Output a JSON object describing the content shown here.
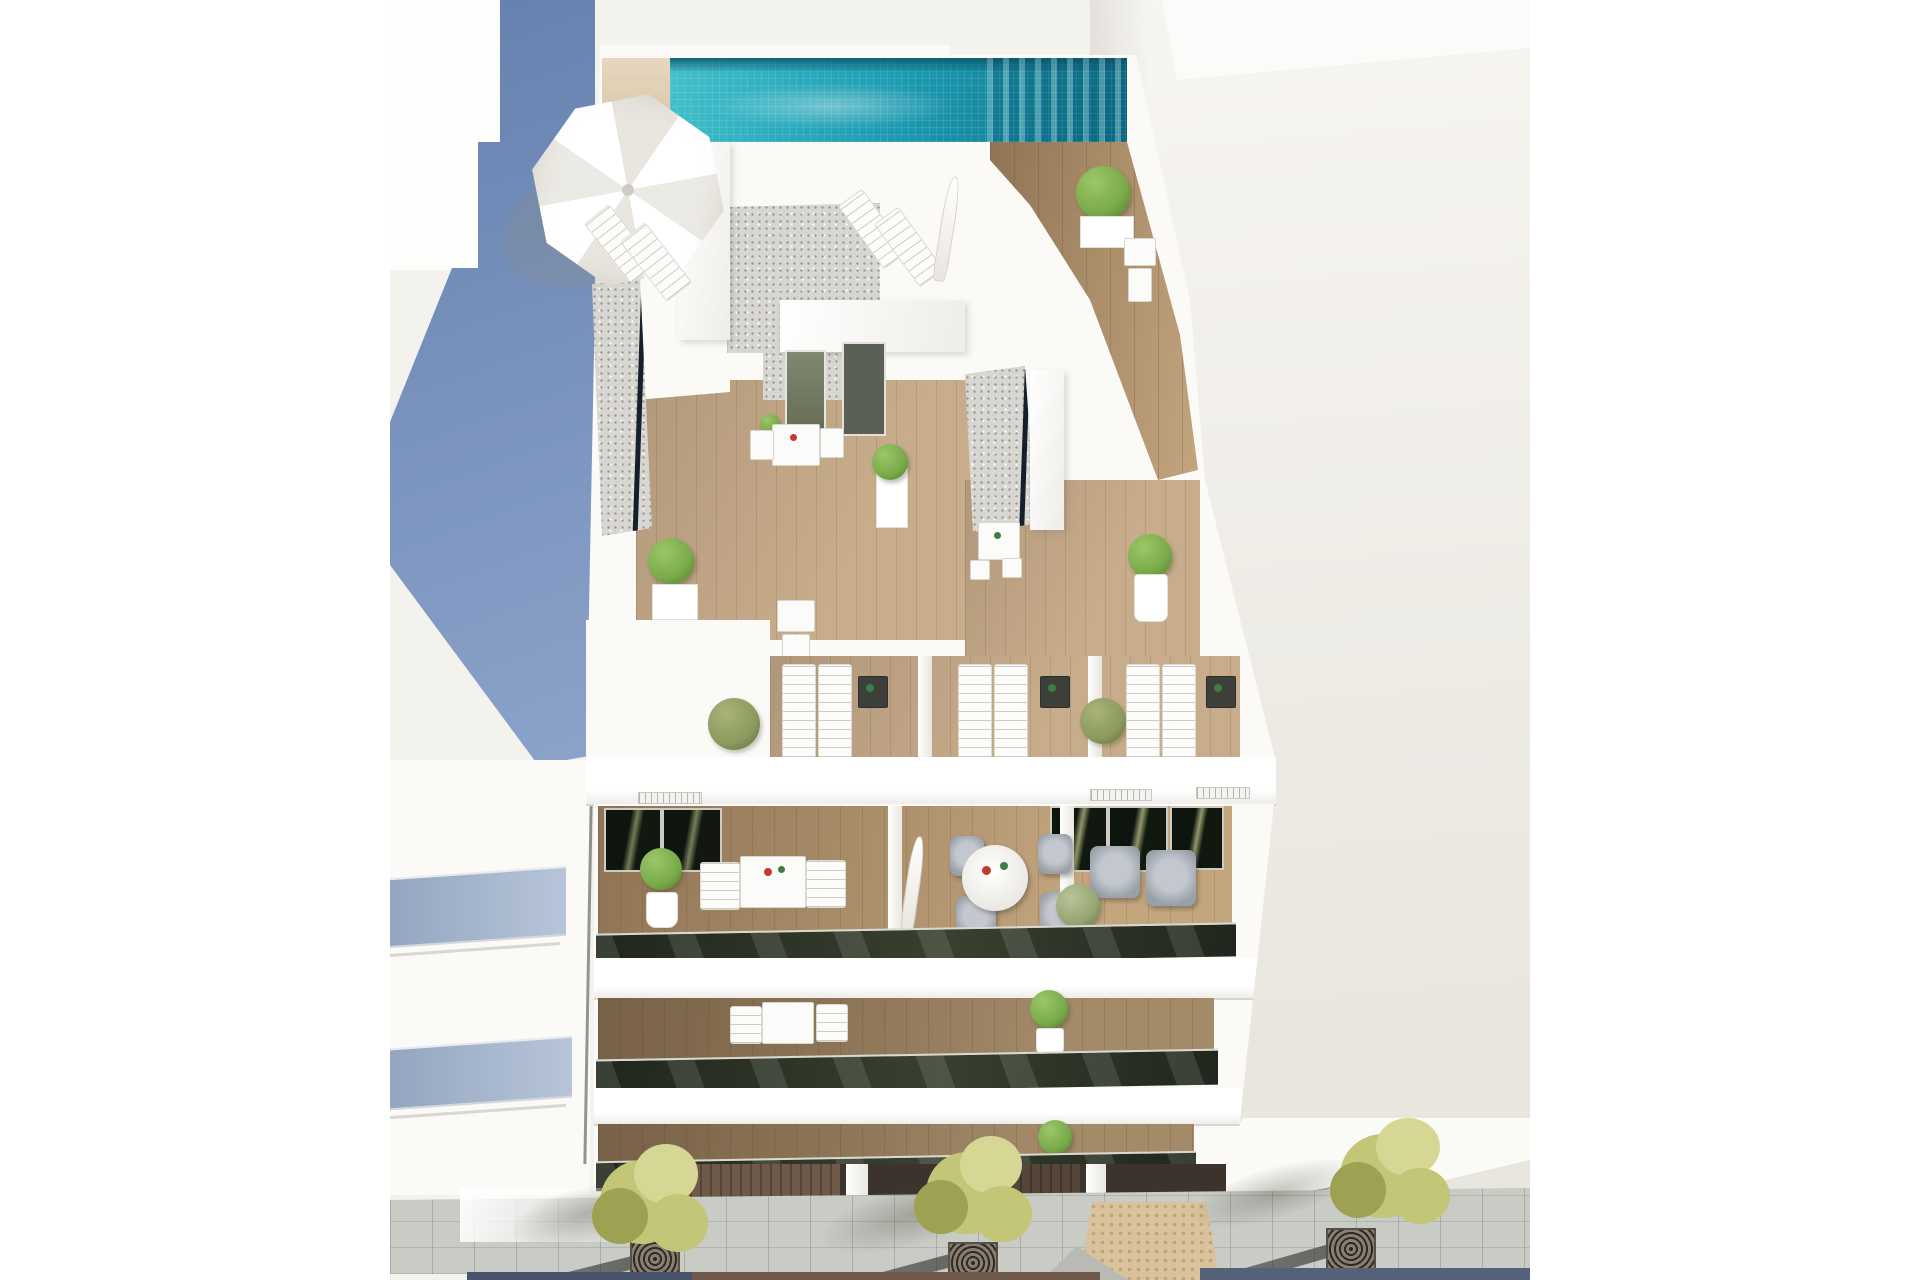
{
  "meta": {
    "kind": "architectural-render",
    "description": "Aerial 3D render of a white modern apartment building with rooftop pool, roof terraces with sun loungers, tiered balconies and a tree-lined sidewalk"
  },
  "colors": {
    "page_bg": "#ffffff",
    "render_bg": "#f4f2ed",
    "pool_light": "#45c1cb",
    "pool_mid": "#1b97ad",
    "pool_deep": "#0c6e89",
    "pool_edge": "#0a5468",
    "deck_beige_1": "#e6d8bf",
    "deck_beige_2": "#d6c3a2",
    "wood_1": "#8f7455",
    "wood_2": "#a98c68",
    "wood_3": "#c3a57e",
    "terrace_wood_1": "#c8ad8c",
    "terrace_wood_2": "#b1977a",
    "gravel": "#d8d6d1",
    "white_wall": "#fbfaf7",
    "glass_dark_1": "#20261d",
    "glass_dark_2": "#39402f",
    "glass_line": "#16202c",
    "door_olive_1": "#818870",
    "door_olive_2": "#5f6650",
    "blue_shadow_1": "#6480ae",
    "blue_shadow_2": "#8ba3c9",
    "neighbor_glass": "#93a6c0",
    "plant_green": "#79aa49",
    "plant_olive": "#8c9a5e",
    "street_tree_1": "#c3c577",
    "street_tree_2": "#9da253",
    "street_tree_3": "#d6d795",
    "pave": "#c9cbc5",
    "pave_sun": "#efefec",
    "tactile": "#dac39c",
    "tactile_dot": "#c0a478",
    "grate_plate": "#6b6256",
    "grate_ring": "#2e2a26",
    "road_blue": "#46536b",
    "road_brown": "#6f594a",
    "road_blue2": "#556179",
    "furn_white": "#fbfbf9",
    "furn_gray": "#9aa0a8",
    "item_red": "#c23b2e",
    "item_green": "#3f7d46",
    "right_ground_1": "#f7f5f1",
    "right_ground_2": "#e9e6df",
    "seam": "#3d3e44",
    "slab_shadow": "#d8d6d0",
    "umbrella_1": "#ffffff",
    "umbrella_2": "#eceae4"
  },
  "scene": {
    "objects": [
      "rooftop-pool",
      "pool-deck",
      "large-parasol",
      "sun-loungers",
      "roof-terraces",
      "gravel-roof-planters",
      "terrace-plants",
      "outdoor-tables",
      "balconies",
      "glass-balustrades",
      "round-dining-set",
      "lounge-armchairs",
      "garage-entrance",
      "sidewalk-pavement",
      "street-trees",
      "tree-grates",
      "tactile-paving",
      "neighbouring-building",
      "shadowed-facade"
    ],
    "counts": {
      "street_trees": 3,
      "roof_lounger_pairs": 3,
      "balcony_levels_visible": 3
    }
  }
}
